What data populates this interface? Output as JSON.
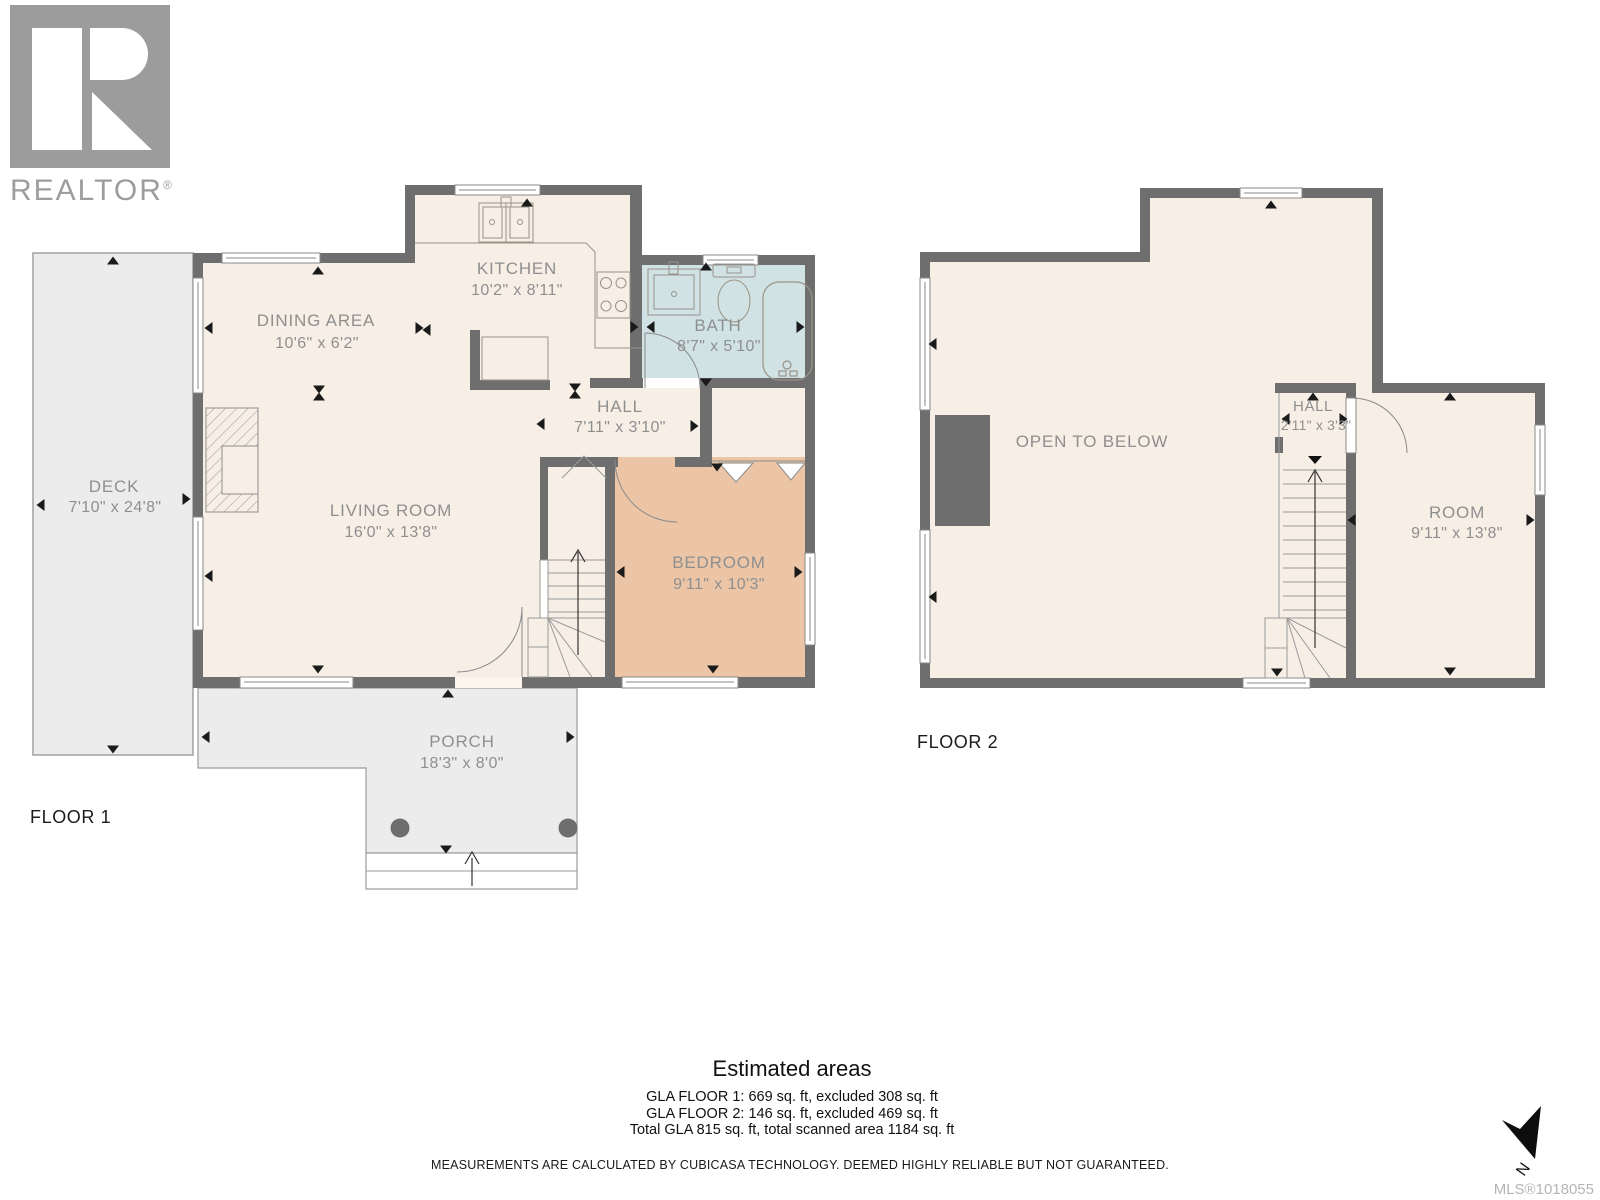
{
  "logo": {
    "brand": "REALTOR",
    "reg": "®"
  },
  "floor1": {
    "label": "FLOOR 1",
    "kitchen": {
      "name": "KITCHEN",
      "dims": "10'2\" x 8'11\""
    },
    "dining": {
      "name": "DINING AREA",
      "dims": "10'6\" x 6'2\""
    },
    "bath": {
      "name": "BATH",
      "dims": "8'7\" x 5'10\""
    },
    "hall": {
      "name": "HALL",
      "dims": "7'11\" x 3'10\""
    },
    "living": {
      "name": "LIVING ROOM",
      "dims": "16'0\" x 13'8\""
    },
    "bedroom": {
      "name": "BEDROOM",
      "dims": "9'11\" x 10'3\""
    },
    "deck": {
      "name": "DECK",
      "dims": "7'10\" x 24'8\""
    },
    "porch": {
      "name": "PORCH",
      "dims": "18'3\" x 8'0\""
    }
  },
  "floor2": {
    "label": "FLOOR 2",
    "open_below": {
      "name": "OPEN TO BELOW"
    },
    "hall": {
      "name": "HALL",
      "dims": "2'11\" x 3'3\""
    },
    "room": {
      "name": "ROOM",
      "dims": "9'11\" x 13'8\""
    }
  },
  "summary": {
    "title": "Estimated areas",
    "lines": [
      "GLA FLOOR 1: 669 sq. ft, excluded 308 sq. ft",
      "GLA FLOOR 2: 146 sq. ft, excluded 469 sq. ft",
      "Total GLA 815 sq. ft, total scanned area 1184 sq. ft"
    ]
  },
  "disclaimer": "MEASUREMENTS ARE CALCULATED BY CUBICASA TECHNOLOGY. DEEMED HIGHLY RELIABLE BUT NOT GUARANTEED.",
  "mls": "MLS®1018055",
  "compass": {
    "label": "N"
  },
  "colors": {
    "wall": "#6e6e6e",
    "floor": "#f7eee6",
    "bedroom": "#ebc5a6",
    "bath": "#d0e2e3",
    "outdoor": "#ececec",
    "label_text": "#8f8f8f"
  }
}
